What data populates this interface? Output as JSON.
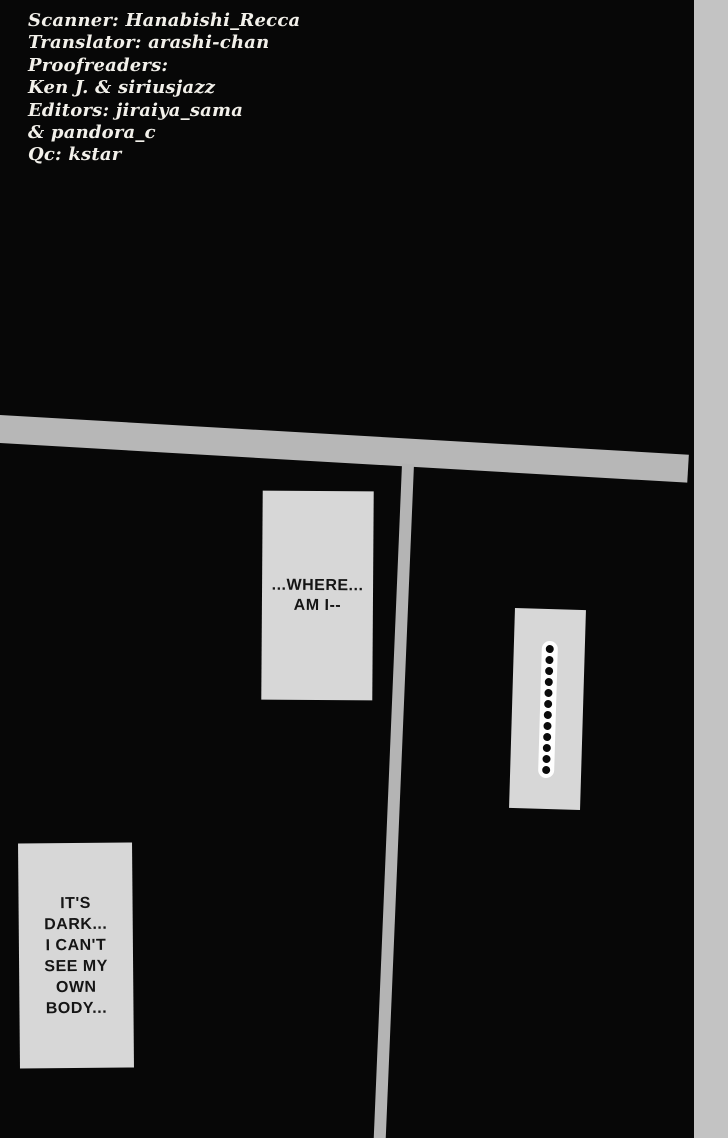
{
  "page": {
    "type": "manga scanlation page",
    "colors": {
      "background": "#070707",
      "panel_border": "#b7b7b7",
      "page_edge_strip": "#c3c3c3",
      "bubble_fill": "#d7d7d7",
      "dots_halo": "#fefefe",
      "credits_text": "#f2f0ea",
      "bubble_text": "#151515"
    }
  },
  "credits": {
    "lines": [
      "Scanner: Hanabishi_Recca",
      "Translator: arashi-chan",
      "Proofreaders:",
      "Ken J. & siriusjazz",
      "Editors: jiraiya_sama",
      "& pandora_c",
      "Qc: kstar"
    ]
  },
  "bubbles": {
    "where": {
      "lines": [
        "...WHERE...",
        "AM I--"
      ]
    },
    "silence": {
      "dot_count": 12
    },
    "dark": {
      "lines": [
        "IT'S",
        "DARK...",
        "I CAN'T",
        "SEE MY",
        "OWN",
        "BODY..."
      ]
    }
  }
}
